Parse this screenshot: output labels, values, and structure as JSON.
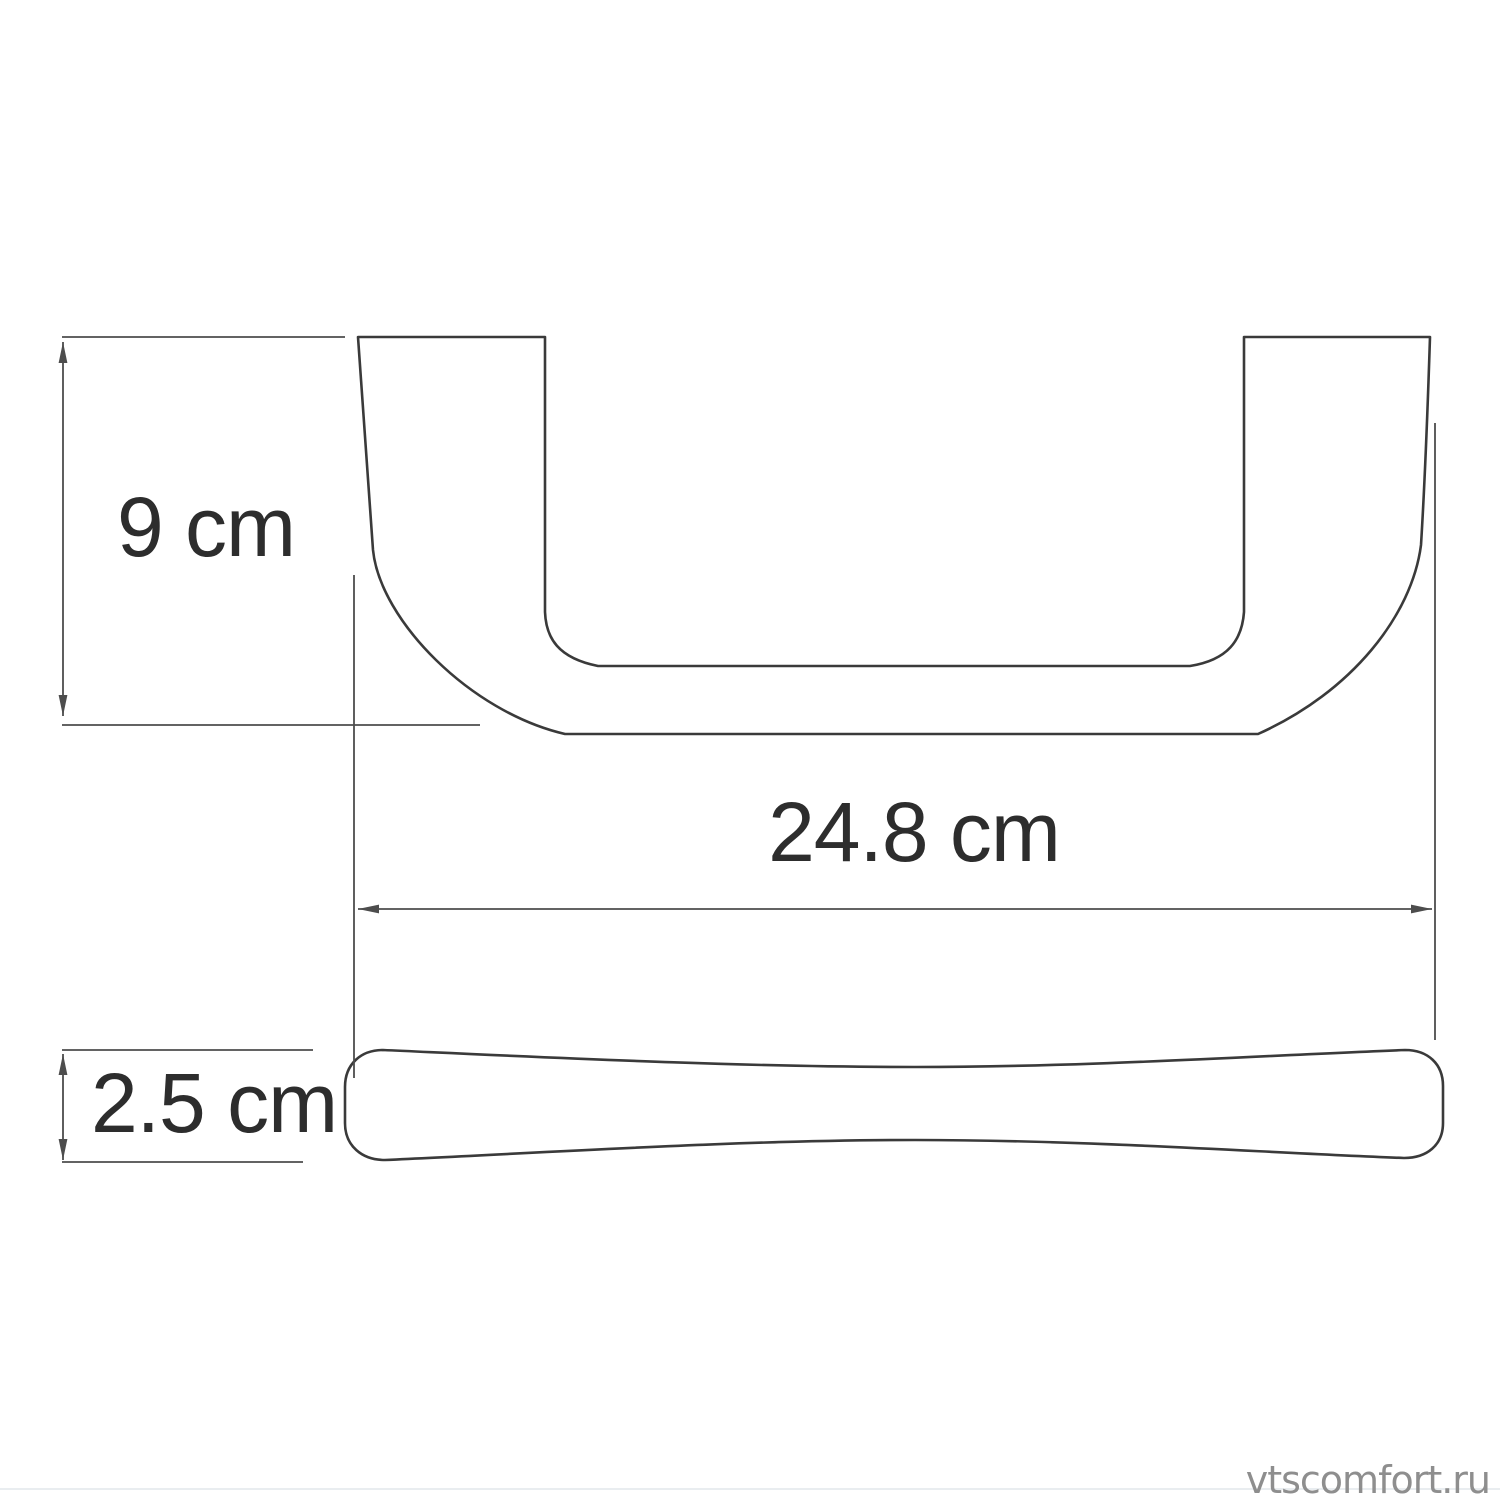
{
  "canvas": {
    "width": 1500,
    "height": 1500,
    "background": "#ffffff"
  },
  "views": {
    "front": {
      "name": "handle front view (U-shaped bracket)"
    },
    "side": {
      "name": "handle side profile (waisted bar)"
    }
  },
  "dimensions": {
    "height": {
      "label": "9 cm"
    },
    "length": {
      "label": "24.8 cm"
    },
    "thickness": {
      "label": "2.5 cm"
    }
  },
  "colors": {
    "outline": "#3a3a3a",
    "dimension": "#4d4d4d",
    "label": "#2d2d2d",
    "watermark": "#8e8e8e",
    "footer_rule": "#e9edf0"
  },
  "watermark": {
    "text": "vtscomfort.ru"
  }
}
